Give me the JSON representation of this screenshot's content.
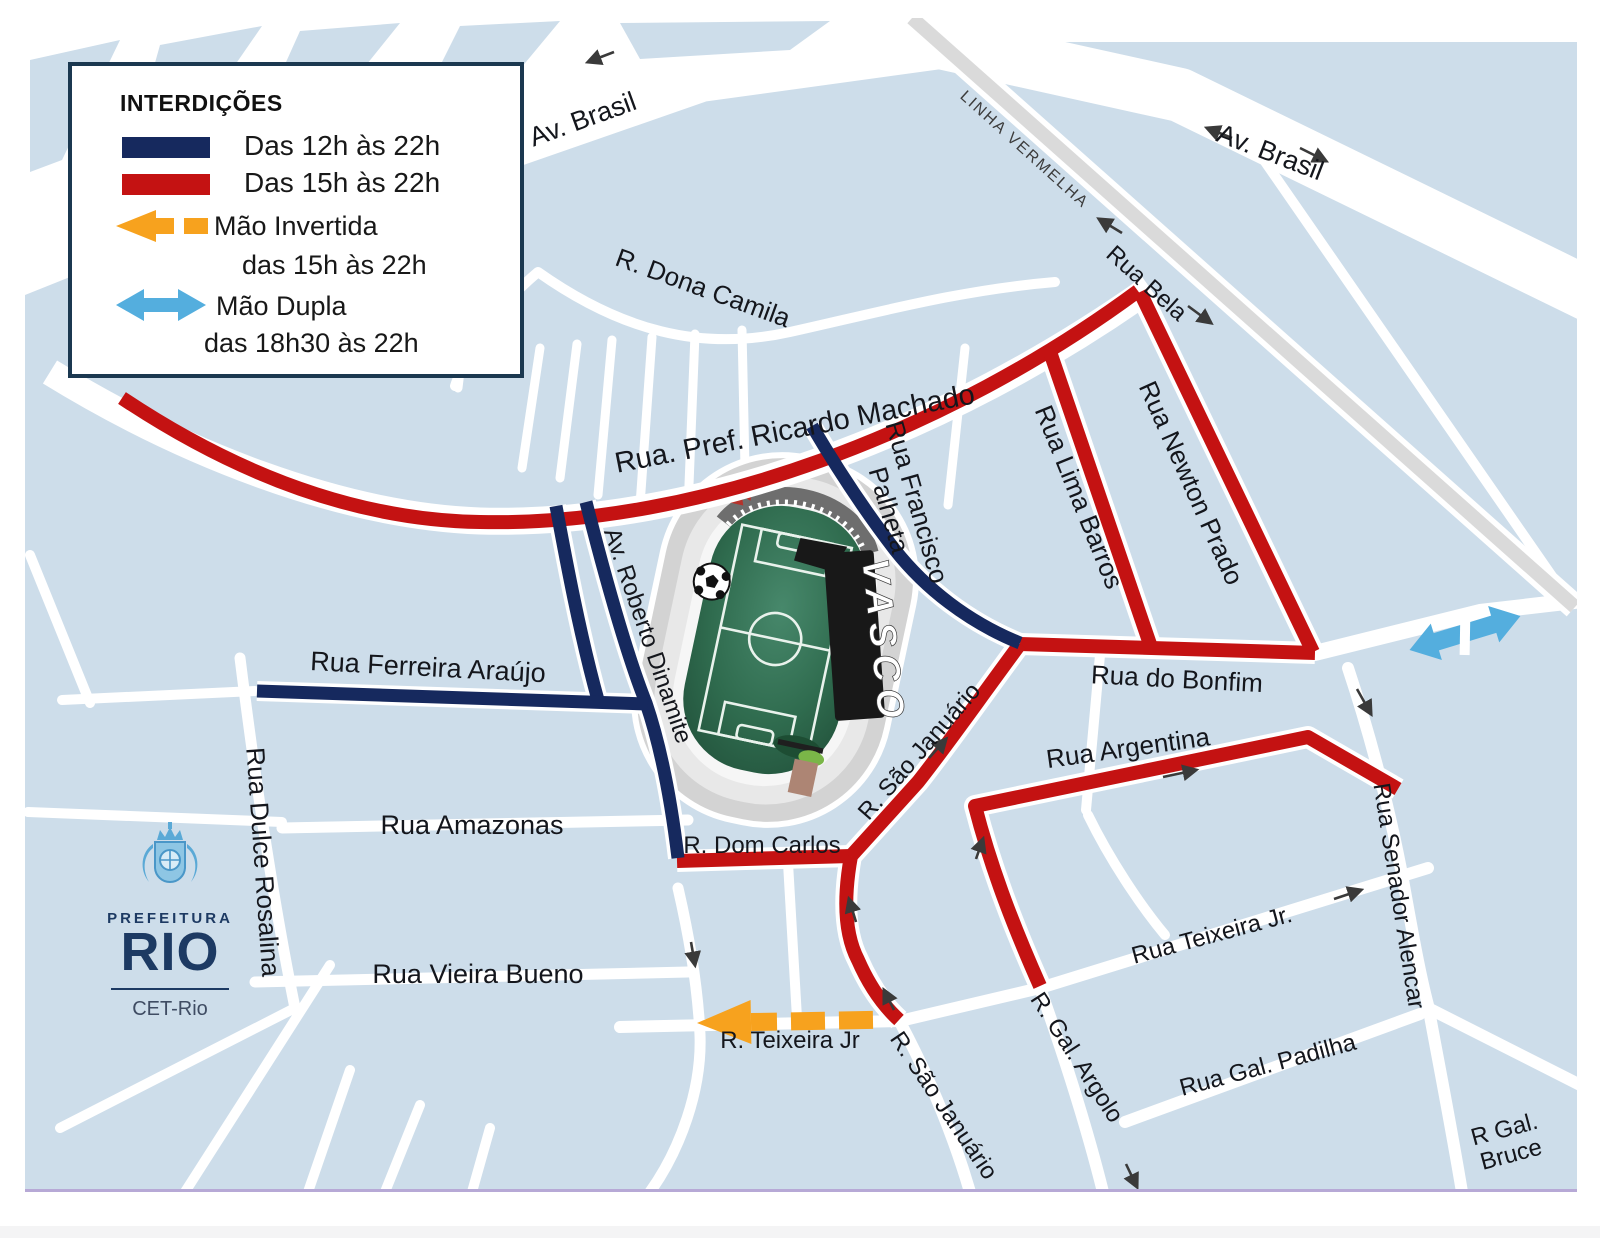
{
  "legend": {
    "title": "INTERDIÇÕES",
    "items": [
      {
        "label": "Das 12h às 22h",
        "color": "#16295e"
      },
      {
        "label": "Das 15h às 22h",
        "color": "#c41212"
      },
      {
        "label": "Mão Invertida",
        "sublabel": "das 15h às 22h",
        "color": "#f7a21e"
      },
      {
        "label": "Mão Dupla",
        "sublabel": "das 18h30 às 22h",
        "color": "#54aede"
      }
    ]
  },
  "streets": {
    "av_brasil_left": "Av. Brasil",
    "av_brasil_right": "Av. Brasil",
    "linha_vermelha": "LINHA VERMELHA",
    "rua_bela": "Rua Bela",
    "r_dona_camila": "R. Dona Camila",
    "rua_pref_ricardo_machado": "Rua. Pref. Ricardo Machado",
    "rua_francisco_palheta_1": "Rua Francisco",
    "rua_francisco_palheta_2": "Palheta",
    "av_roberto_dinamite": "Av. Roberto Dinamite",
    "rua_lima_barros": "Rua Lima Barros",
    "rua_newton_prado": "Rua Newton Prado",
    "rua_do_bonfim": "Rua do Bonfim",
    "rua_ferreira_araujo": "Rua Ferreira Araújo",
    "rua_dulce_rosalina": "Rua Dulce Rosalina",
    "rua_amazonas": "Rua Amazonas",
    "rua_vieira_bueno": "Rua Vieira Bueno",
    "r_dom_carlos": "R. Dom Carlos",
    "r_sao_januario_upper": "R. São Januário",
    "r_sao_januario_lower": "R.  São Januário",
    "r_gal_argolo": "R. Gal. Argolo",
    "rua_teixeira_jr_right": "Rua Teixeira Jr.",
    "rua_gal_padilha": "Rua Gal. Padilha",
    "rua_senador_alencar": "Rua Senador Alencar",
    "r_gal_bruce_1": "R Gal.",
    "r_gal_bruce_2": "Bruce",
    "rua_argentina": "Rua Argentina",
    "r_teixeira_jr": "R.  Teixeira Jr"
  },
  "stadium": {
    "banner": "VASCO"
  },
  "logo": {
    "prefeitura": "PREFEITURA",
    "rio": "RIO",
    "dept": "CET-Rio"
  },
  "colors": {
    "background": "#cdddea",
    "closed_12_22": "#16295e",
    "closed_15_22": "#c41212",
    "mao_invertida": "#f7a21e",
    "mao_dupla": "#54aede",
    "highway": "#dadada"
  }
}
